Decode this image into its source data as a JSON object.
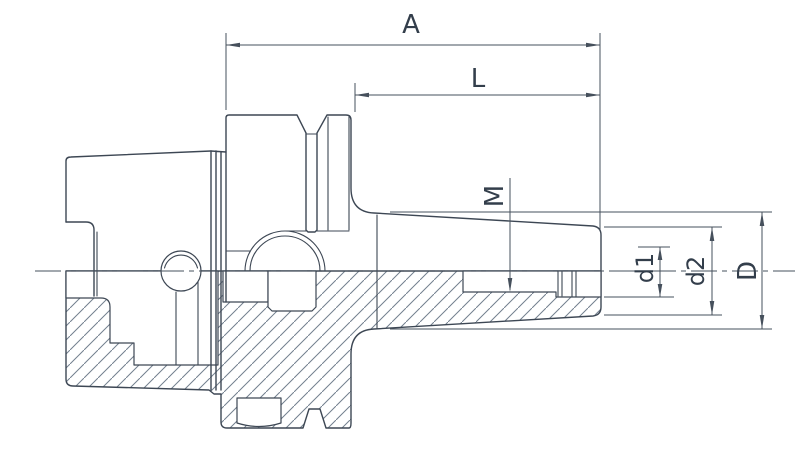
{
  "labels": {
    "overall_length": "A",
    "projection_length": "L",
    "thread": "M",
    "bore_diameter": "d1",
    "nose_diameter": "d2",
    "body_diameter": "D"
  },
  "colors": {
    "line": "#3d4754",
    "dimension": "#46505c",
    "hatch": "#72808e",
    "background": "#ffffff",
    "text": "#333e4b"
  }
}
